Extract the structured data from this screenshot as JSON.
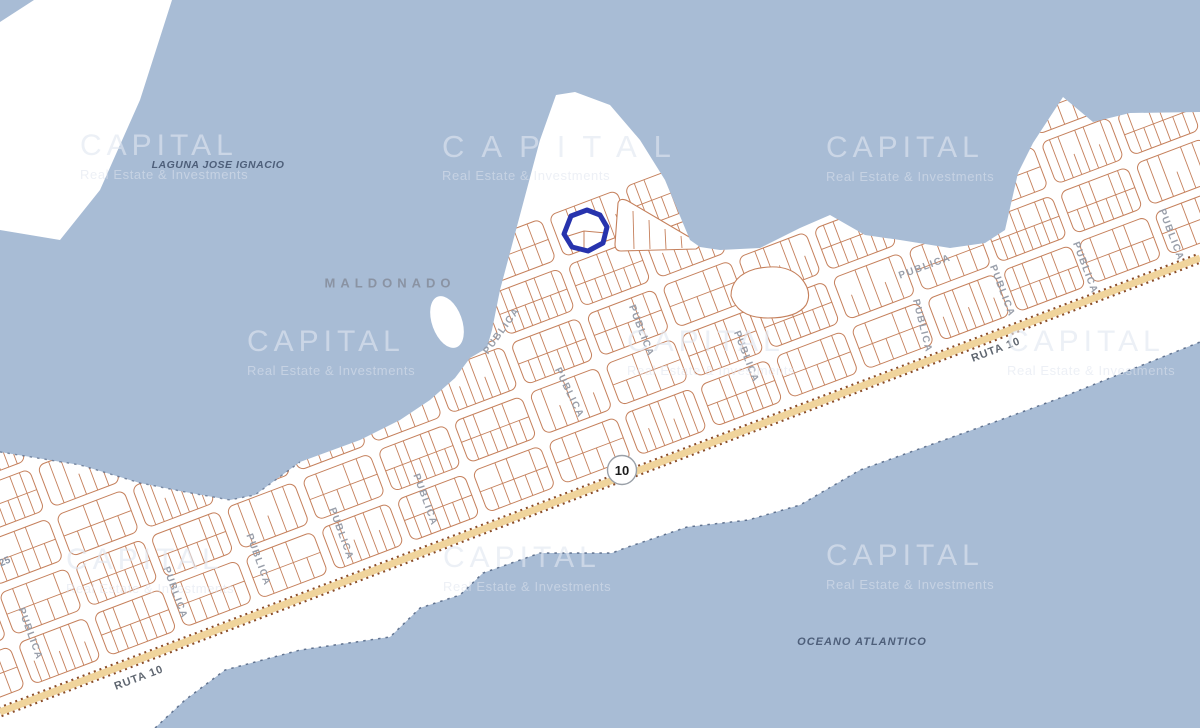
{
  "watermark": {
    "title": "CAPITAL",
    "subtitle": "Real Estate & Investments"
  },
  "labels": {
    "publica": "PUBLICA",
    "ruta10": "RUTA 10",
    "route_shield": "10",
    "laguna": "LAGUNA JOSE IGNACIO",
    "city": "MALDONADO",
    "ocean": "OCEANO ATLANTICO",
    "route25": "25"
  },
  "colors": {
    "water": "#a8bcd5",
    "land": "#ffffff",
    "parcel_line": "#c5805c",
    "road_fill": "#f0d49c",
    "road_edge": "#8a4c28",
    "highlight_parcel": "#2733ad",
    "street_label": "#949aa6",
    "map_label": "#4e5f7a"
  }
}
